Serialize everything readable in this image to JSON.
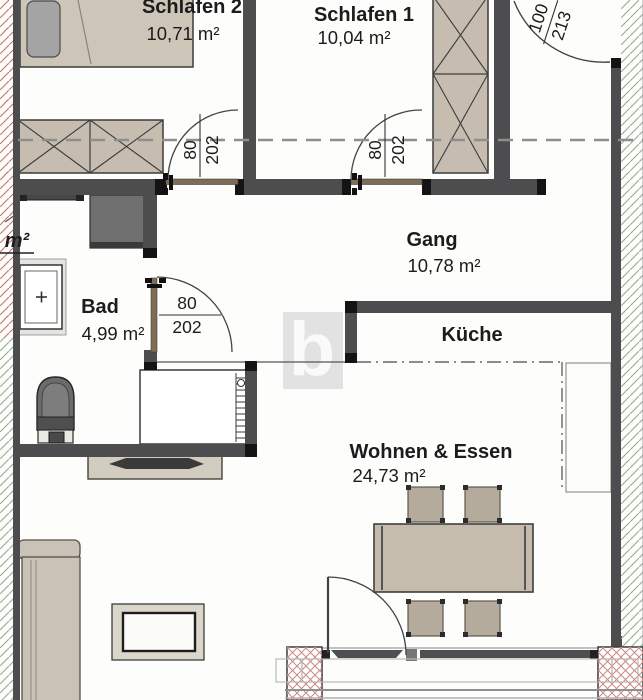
{
  "plan_title": "apartment-floor-plan",
  "watermark": "b",
  "cut_label": "m²",
  "rooms": {
    "schlafen2": {
      "name": "Schlafen 2",
      "area": "10,71 m²"
    },
    "schlafen1": {
      "name": "Schlafen 1",
      "area": "10,04 m²"
    },
    "gang": {
      "name": "Gang",
      "area": "10,78 m²"
    },
    "bad": {
      "name": "Bad",
      "area": "4,99 m²"
    },
    "kueche": {
      "name": "Küche"
    },
    "wohnen": {
      "name": "Wohnen & Essen",
      "area": "24,73 m²"
    }
  },
  "doors": {
    "schlafen2": {
      "w": "80",
      "h": "202"
    },
    "schlafen1": {
      "w": "80",
      "h": "202"
    },
    "bad": {
      "w": "80",
      "h": "202"
    },
    "entrance": {
      "w": "100",
      "h": "213"
    }
  },
  "colors": {
    "wall": "#4d4d50",
    "wall_cap": "#141414",
    "furniture_beige": "#c6bdb0",
    "furniture_light": "#dbd6ca",
    "door_leaf_brown": "#7d6c58",
    "shaft_gray": "#6f6f6f",
    "hatch_red": "#c4726b",
    "hatch_green": "#8fae8f",
    "dashed_line": "#8e8e8e",
    "watermark_bg": "#e2e2e2",
    "text": "#1c1c1c"
  }
}
